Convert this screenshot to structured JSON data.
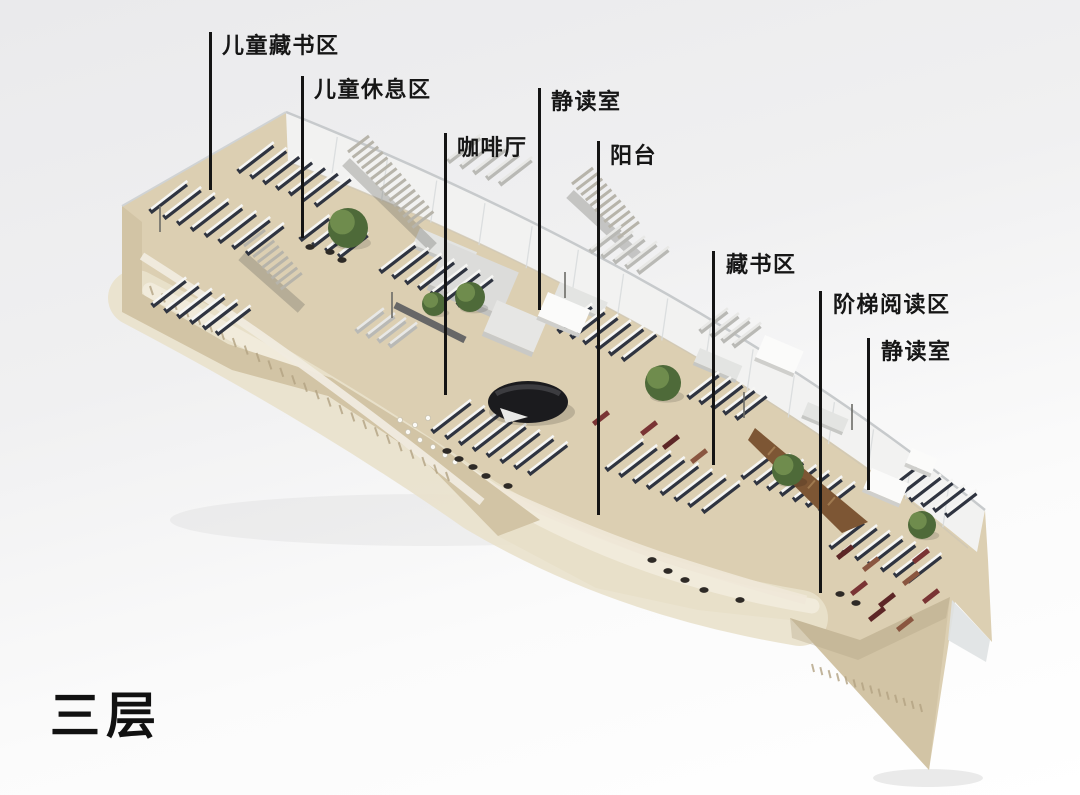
{
  "page": {
    "floor_label": "三层"
  },
  "diagram": {
    "type": "isometric-cutaway-floorplan",
    "subject": "library third floor axonometric render",
    "labels": [
      {
        "id": "children-stacks",
        "text": "儿童藏书区"
      },
      {
        "id": "children-lounge",
        "text": "儿童休息区"
      },
      {
        "id": "cafe",
        "text": "咖啡厅"
      },
      {
        "id": "quiet-reading-left",
        "text": "静读室"
      },
      {
        "id": "balcony",
        "text": "阳台"
      },
      {
        "id": "stacks",
        "text": "藏书区"
      },
      {
        "id": "stepped-reading",
        "text": "阶梯阅读区"
      },
      {
        "id": "quiet-reading-right",
        "text": "静读室"
      }
    ],
    "colors": {
      "label_text": "#161616",
      "leader_line": "#141414",
      "floor": "#dccfb2",
      "floor_light": "#e6dcc6",
      "sand": "#e9e1cb",
      "sand_path": "#f1ebdc",
      "wall": "#d2c4a5",
      "wall_dark": "#b3a383",
      "glass": "#f3f5f6",
      "glass_edge": "#c7cacc",
      "shelf_dark": "#2f3440",
      "shelf_top": "#f6f6f4",
      "desk_light": "#e8e8e6",
      "desk_side": "#b9b9b5",
      "tree_dark": "#4e6a39",
      "tree_light": "#6f8c4d",
      "stair": "#b7b4aa",
      "pavilion_black": "#1b1b1e",
      "wood_brown": "#7d5634",
      "table_red": "#7a3434",
      "figure_dark": "#2e2a26",
      "shadow": "rgba(0,0,0,0.08)"
    }
  }
}
